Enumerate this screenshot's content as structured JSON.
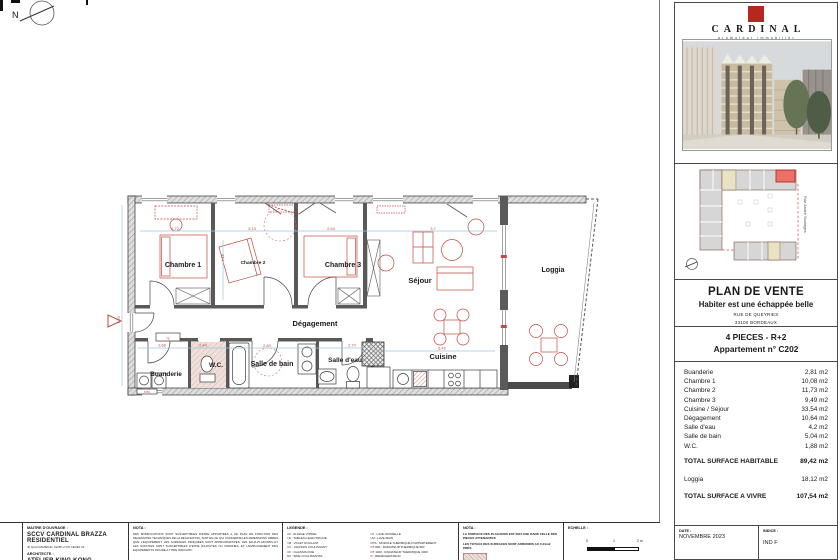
{
  "plan": {
    "north_label": "N",
    "rooms": {
      "chambre1": "Chambre 1",
      "chambre2": "Chambre 2",
      "chambre3": "Chambre 3",
      "sejour": "Séjour",
      "loggia": "Loggia",
      "degagement": "Dégagement",
      "salle_de_bain": "Salle de bain",
      "salle_eau": "Salle d'eau",
      "wc": "W.C.",
      "buanderie": "Buanderie",
      "cuisine": "Cuisine"
    },
    "annotations": {
      "te": "TE",
      "mta": "MTA"
    },
    "dims": {
      "d1": "2,72",
      "d2": "3,13",
      "d3": "2,54",
      "d4": "3,7",
      "d5": "4,15",
      "d6": "1,68",
      "d7": "2,44",
      "d8": "2,80",
      "d9": "2,70",
      "d10": "6,42",
      "d11": "7,20"
    }
  },
  "panel": {
    "brand_name": "CARDINAL",
    "brand_tagline": "promoteur immobilier",
    "siteplan_street": "Rue André Soulages",
    "title": "PLAN DE VENTE",
    "subtitle": "Habiter est une échappée belle",
    "address_line1": "RUE DE QUEYRIES",
    "address_line2": "33100 BORDEAUX",
    "program_type": "4 PIECES - R+2",
    "apartment": "Appartement n° C202",
    "surfaces": {
      "rows": [
        {
          "label": "Buanderie",
          "value": "2,81 m2"
        },
        {
          "label": "Chambre 1",
          "value": "10,08 m2"
        },
        {
          "label": "Chambre 2",
          "value": "11,73 m2"
        },
        {
          "label": "Chambre 3",
          "value": "9,49 m2"
        },
        {
          "label": "Cuisine / Séjour",
          "value": "33,54 m2"
        },
        {
          "label": "Dégagement",
          "value": "10,64 m2"
        },
        {
          "label": "Salle d'eau",
          "value": "4,2 m2"
        },
        {
          "label": "Salle de bain",
          "value": "5,04 m2"
        },
        {
          "label": "W.C.",
          "value": "1,88 m2"
        }
      ],
      "total_habitable_label": "TOTAL SURFACE HABITABLE",
      "total_habitable_value": "89,42 m2",
      "loggia_label": "Loggia",
      "loggia_value": "18,12 m2",
      "total_vivre_label": "TOTAL SURFACE A VIVRE",
      "total_vivre_value": "107,54 m2"
    }
  },
  "titleblock": {
    "maitre_label": "MAITRE D'OUVRAGE :",
    "maitre_name": "SCCV CARDINAL BRAZZA RESIDENTIEL",
    "maitre_addr": "40 QUAI RAMBAUD, 69286 LYON CEDEX 02",
    "architecte_label": "ARCHITECTE :",
    "architecte_name": "ATELIER KING KONG",
    "nota_label": "NOTA :",
    "nota_text": "DES MODIFICATIONS SONT SUSCEPTIBLES D'ETRE APPORTEES A CE PLAN EN FONCTION DES NECESSITES TECHNIQUES DE LA REALISATION, TANT EN CE QUI CONCERNE LES DIMENSIONS LIBRES QUE L'EQUIPEMENT. LES SURFACES INDIQUEES SONT APPROXIMATIVES. LES FAUX-PLAFONDS ET LES SOFFITES SONT SUSCEPTIBLES D'ETRE RAJOUTES OU MODIFIES, ET L'EMPLACEMENT DES EQUIPEMENTS FIGURE A TITRE INDICATIF.",
    "legende_label": "LEGENDE :",
    "legend_col1": [
      "AV : ALLEGE VITREE",
      "TE : TABLEAU ELECTRIQUE",
      "VR : VOLET ROULANT",
      "CC : CHASSIS COULISSANT",
      "CF : CHASSIS FIXE",
      "BC : BAIE COULISSANTE",
      "PF : PORTE FENETRE"
    ],
    "legend_col2": [
      "LV : LAVE-VAISSELLE",
      "LM : LAVE-MAIN",
      "MTA : MODULE THERMIQUE D'APPARTEMENT",
      "RT 800 : RADIATEUR THERMIQUE 800",
      "RT 1000 : RADIATEUR THERMIQUE 1000",
      "R : REFRIGERATEUR",
      "SS : SECHE-SERVIETTE",
      "PL : PLACARD"
    ],
    "nota2_label": "NOTA :",
    "nota2_line1": "LA SURFACE DES PLACARDS EST INCLUSE DANS CELLE DES PIECES ATTENANTES",
    "nota2_line2": "LES TOTAUX DES SURFACES SONT ARRONDIS AU 0,01m2 PRÈS",
    "echelle_label": "ECHELLE :",
    "scale_0": "0",
    "scale_1": "1",
    "scale_2": "2 m",
    "date_label": "DATE :",
    "date_value": "NOVEMBRE 2023",
    "indice_label": "INDICE :",
    "indice_value": "IND F"
  }
}
